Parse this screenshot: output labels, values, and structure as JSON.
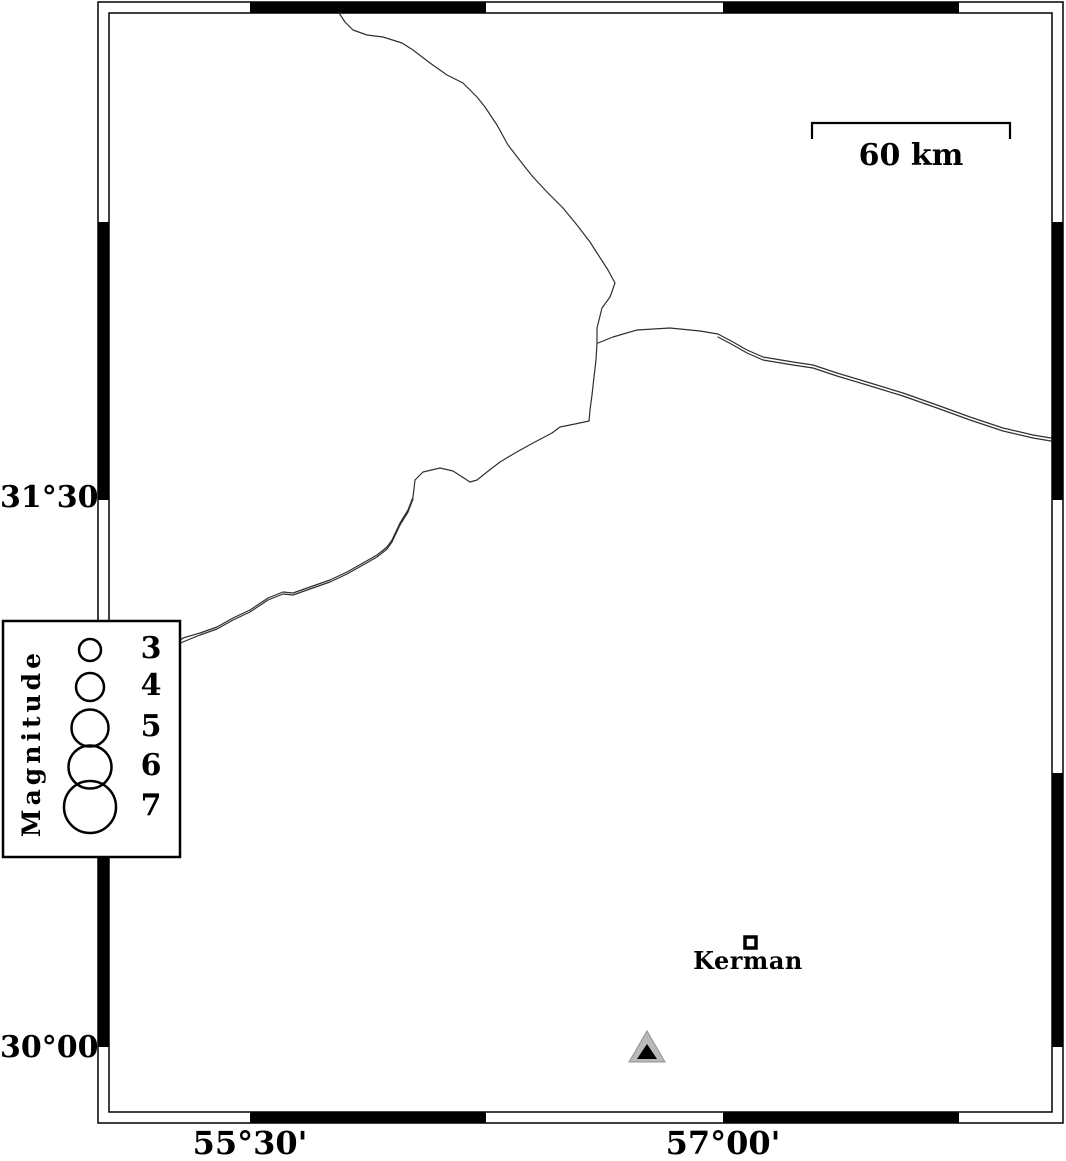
{
  "map": {
    "title": "Epicenter map region around Kerman",
    "scale_bar": {
      "label": "60 km"
    },
    "city": {
      "name": "Kerman",
      "marker": "open-square"
    },
    "station_marker": "gray-black-triangle",
    "axis": {
      "lat_labels": [
        {
          "text": "31°30'"
        },
        {
          "text": "30°00'"
        }
      ],
      "lon_labels": [
        {
          "text": "55°30'"
        },
        {
          "text": "57°00'"
        }
      ]
    },
    "legend": {
      "title": "Magnitude",
      "items": [
        {
          "label": "3"
        },
        {
          "label": "4"
        },
        {
          "label": "5"
        },
        {
          "label": "6"
        },
        {
          "label": "7"
        }
      ]
    },
    "colors": {
      "ink": "#000000",
      "thin_line": "#303030",
      "station_gray": "#b9b9b9",
      "background": "#ffffff"
    }
  }
}
